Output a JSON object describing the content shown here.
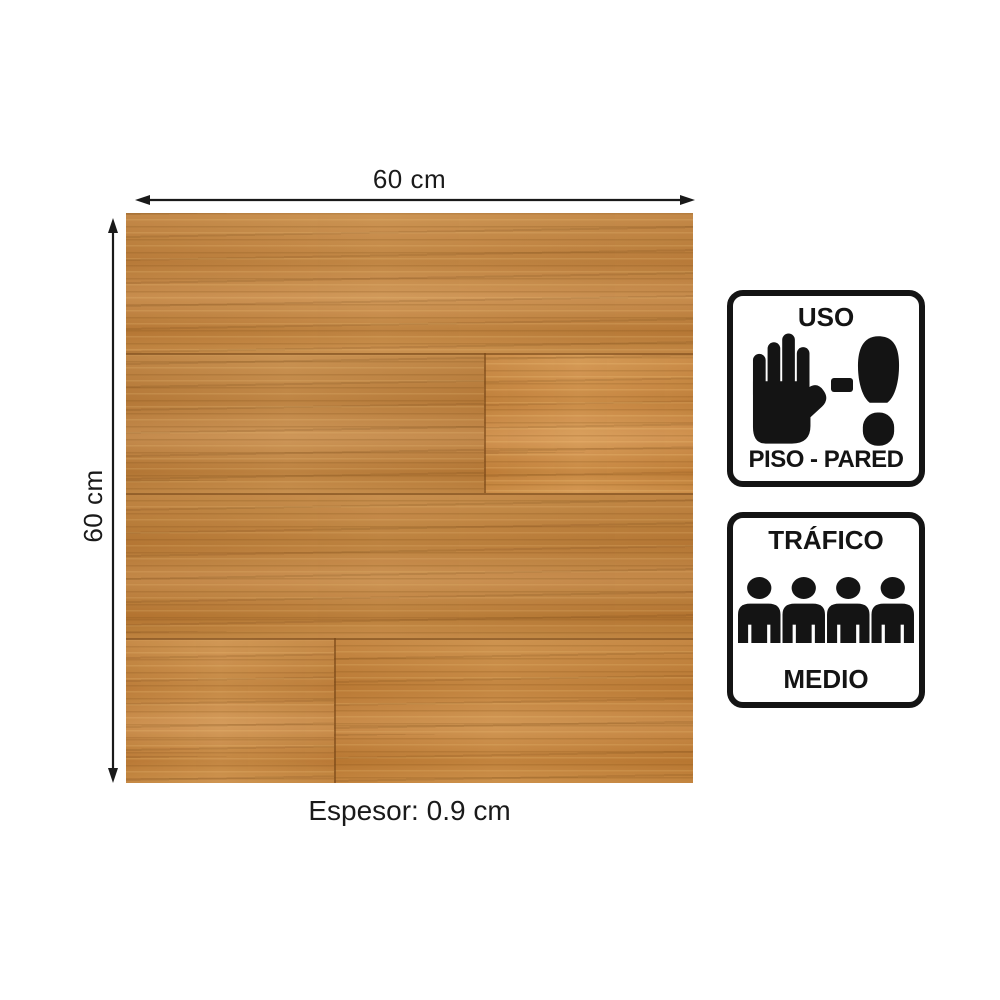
{
  "diagram": {
    "width_label": "60 cm",
    "height_label": "60 cm",
    "thickness_label": "Espesor: 0.9 cm"
  },
  "badges": {
    "uso": {
      "title": "USO",
      "subtitle": "PISO - PARED"
    },
    "trafico": {
      "title": "TRÁFICO",
      "subtitle": "MEDIO",
      "people_count": 4
    }
  },
  "icons": {
    "hand": "stop-hand-icon",
    "dash": "dash-icon",
    "foot": "footprint-icon",
    "people": "people-group-icon",
    "width_arrow": "horizontal-dimension-arrow",
    "height_arrow": "vertical-dimension-arrow"
  },
  "colors": {
    "background": "#ffffff",
    "ink": "#141414",
    "wood_base": "#c1873f",
    "wood_dark": "#a86d2e",
    "wood_light": "#d9a45d",
    "wood_seam": "#8a5a22"
  }
}
